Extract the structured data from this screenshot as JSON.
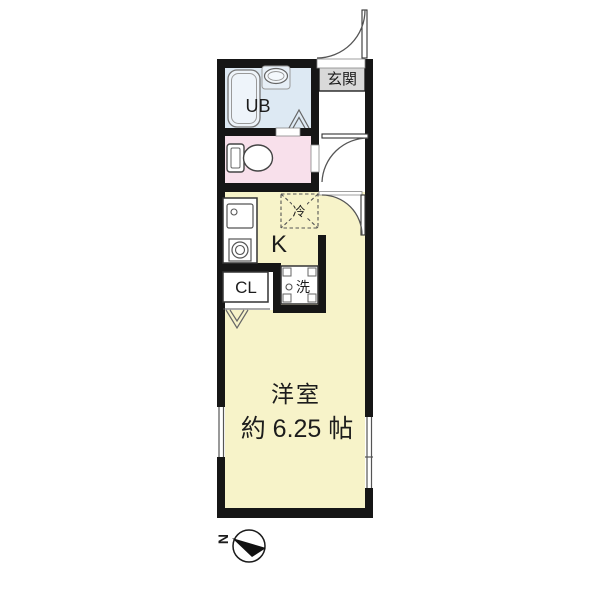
{
  "plan": {
    "type": "japanese-apartment-floor-plan",
    "rooms": {
      "entrance": {
        "label": "玄関"
      },
      "unit_bath": {
        "label": "UB"
      },
      "kitchen": {
        "label": "K"
      },
      "closet": {
        "label": "CL"
      },
      "main_room": {
        "name": "洋室",
        "size": "約 6.25 帖"
      }
    },
    "fixtures": {
      "refrigerator": {
        "label": "冷"
      },
      "washing_machine": {
        "label": "洗"
      }
    },
    "compass": {
      "north_label": "N"
    },
    "colors": {
      "wall": "#161616",
      "room_yellow": "#f7f3c9",
      "bath_blue": "#dde9f3",
      "toilet_pink": "#f8e0eb",
      "entrance_gray": "#d9d9d9",
      "line": "#555555"
    }
  }
}
